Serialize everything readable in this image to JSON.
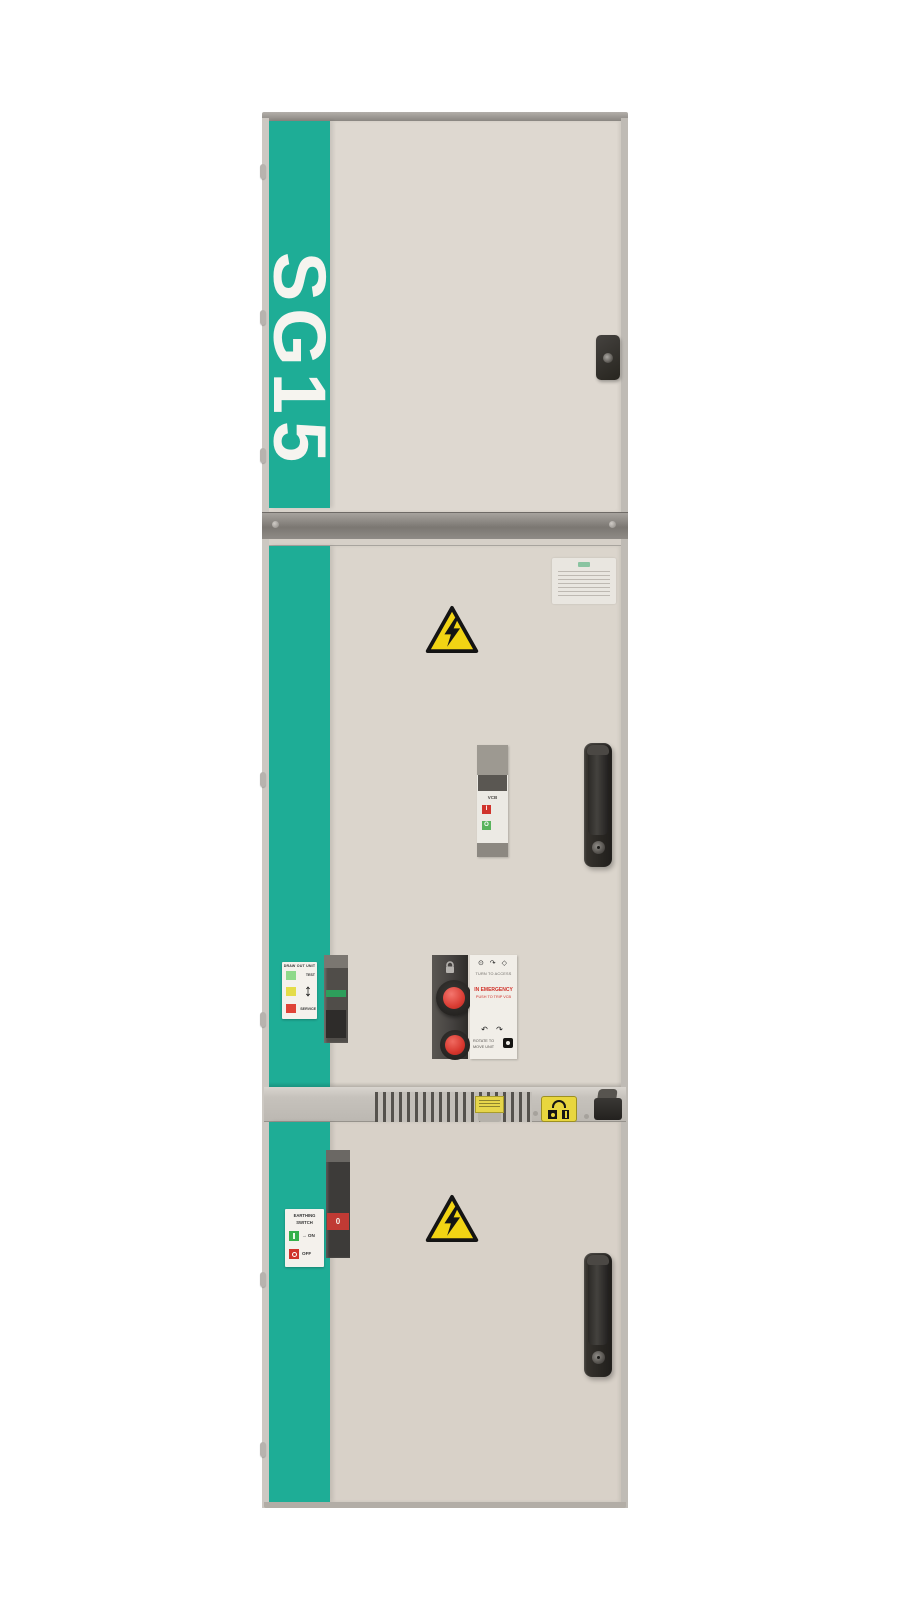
{
  "brand": {
    "logo": "SG15"
  },
  "palette": {
    "accent_teal": "#1ead96",
    "cabinet_beige": "#dbd5cc",
    "hazard_yellow": "#f2d414",
    "button_red": "#d43a32"
  },
  "draw_out_label": {
    "title": "DRAW OUT UNIT",
    "top_position": "TEST",
    "bottom_position": "SERVICE",
    "arrow": "↕"
  },
  "vcb_indicator": {
    "label": "VCB",
    "closed_symbol": "I",
    "open_symbol": "O"
  },
  "access_panel": {
    "key_icons": "⊙ ↷ ◇",
    "turn_to_access": "TURN TO ACCESS",
    "emergency_line1": "IN EMERGENCY",
    "emergency_line2": "PUSH TO TRIP VCB",
    "rotate_icons": "↶ ↷",
    "rotate_line1": "ROTATE TO",
    "rotate_line2": "MOVE UNIT"
  },
  "earthing": {
    "title_line1": "EARTHING",
    "title_line2": "SWITCH",
    "on_arrow": "→",
    "on_text": "ON",
    "off_text": "OFF",
    "position_value": "0"
  }
}
